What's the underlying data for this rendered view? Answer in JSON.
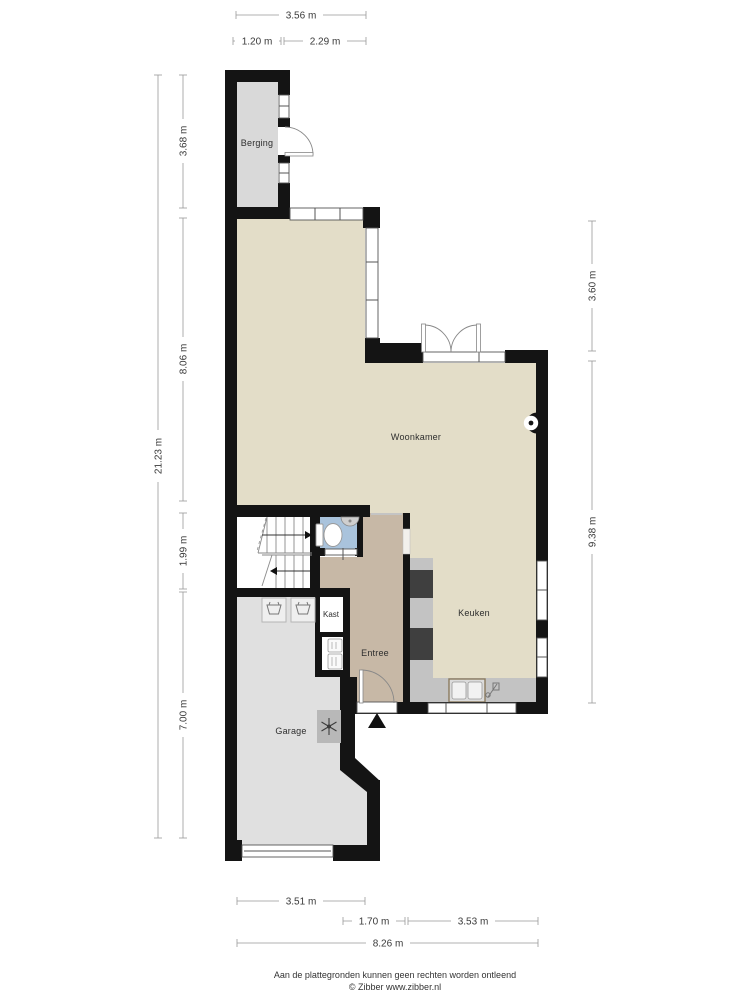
{
  "floorplan": {
    "rooms": {
      "berging": "Berging",
      "woonkamer": "Woonkamer",
      "keuken": "Keuken",
      "entree": "Entree",
      "kast": "Kast",
      "garage": "Garage"
    },
    "dimensions": {
      "top": [
        {
          "text": "3.56 m"
        },
        {
          "text": "1.20 m"
        },
        {
          "text": "2.29 m"
        }
      ],
      "bottom": [
        {
          "text": "3.51 m"
        },
        {
          "text": "1.70 m"
        },
        {
          "text": "3.53 m"
        },
        {
          "text": "8.26 m"
        }
      ],
      "left": [
        {
          "text": "21.23 m"
        },
        {
          "text": "3.68 m"
        },
        {
          "text": "8.06 m"
        },
        {
          "text": "1.99 m"
        },
        {
          "text": "7.00 m"
        }
      ],
      "right": [
        {
          "text": "3.60 m"
        },
        {
          "text": "9.38 m"
        }
      ]
    },
    "footer": {
      "disclaimer": "Aan de plattegronden kunnen geen rechten worden ontleend",
      "copyright": "© Zibber www.zibber.nl"
    },
    "colors": {
      "wall": "#141414",
      "living_floor": "#e3ddc8",
      "entry_floor": "#c7b8a6",
      "storage_floor": "#d9d9d9",
      "garage_floor": "#e0e0e0",
      "wc_floor": "#a9c3dc",
      "counter": "#c3c3c3",
      "appliance": "#3f3f3f",
      "sink_frame": "#8b7a5e"
    }
  }
}
